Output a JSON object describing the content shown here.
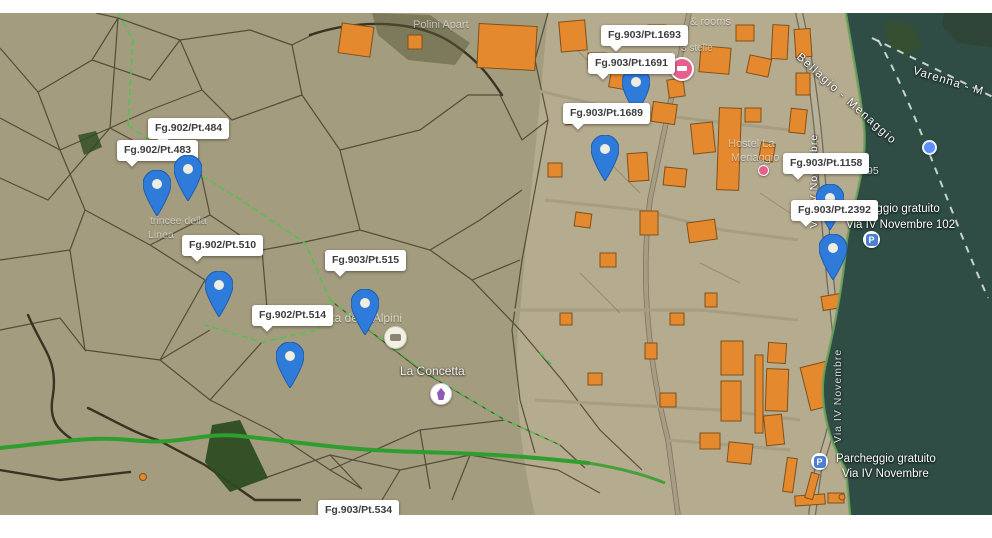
{
  "map_type": "satellite-cadastral-hybrid",
  "labels": [
    {
      "text": "Fg.902/Pt.484"
    },
    {
      "text": "Fg.902/Pt.483"
    },
    {
      "text": "Fg.902/Pt.510"
    },
    {
      "text": "Fg.902/Pt.514"
    },
    {
      "text": "Fg.903/Pt.515"
    },
    {
      "text": "Fg.903/Pt.1693"
    },
    {
      "text": "Fg.903/Pt.1691"
    },
    {
      "text": "Fg.903/Pt.1689"
    },
    {
      "text": "Fg.903/Pt.1158"
    },
    {
      "text": "Fg.903/Pt.2392"
    },
    {
      "text": "Fg.903/Pt.534"
    }
  ],
  "map_texts": {
    "poi_top": "Polini Apart",
    "rooms": "& rooms",
    "stars": "3 stelle",
    "hostel1": "Hostel La",
    "hostel2": "Menaggio",
    "trincee1": "trincee della",
    "trincee2": "Linea",
    "alpini": "tta degli Alpini",
    "concetta": "La Concetta",
    "number_95": "95",
    "ferry_route_1": "Varenna - M",
    "ferry_route_2": "Bellagio - Menaggio",
    "street_main": "Via IV Novembre",
    "street_main_2": "Via IV Novembre",
    "parking_north_1": "Parcheggio gratuito",
    "parking_north_2": "Via IV Novembre 102",
    "parking_south_1": "Parcheggio gratuito",
    "parking_south_2": "Via IV Novembre"
  },
  "colors": {
    "pin_blue": "#2f7bd9",
    "water": "#2f4d45",
    "building_orange": "#e5892e",
    "cadastral_bg": "#a49c7f",
    "town_bg": "#b5ab8f",
    "green_path": "#2f9e2e"
  }
}
